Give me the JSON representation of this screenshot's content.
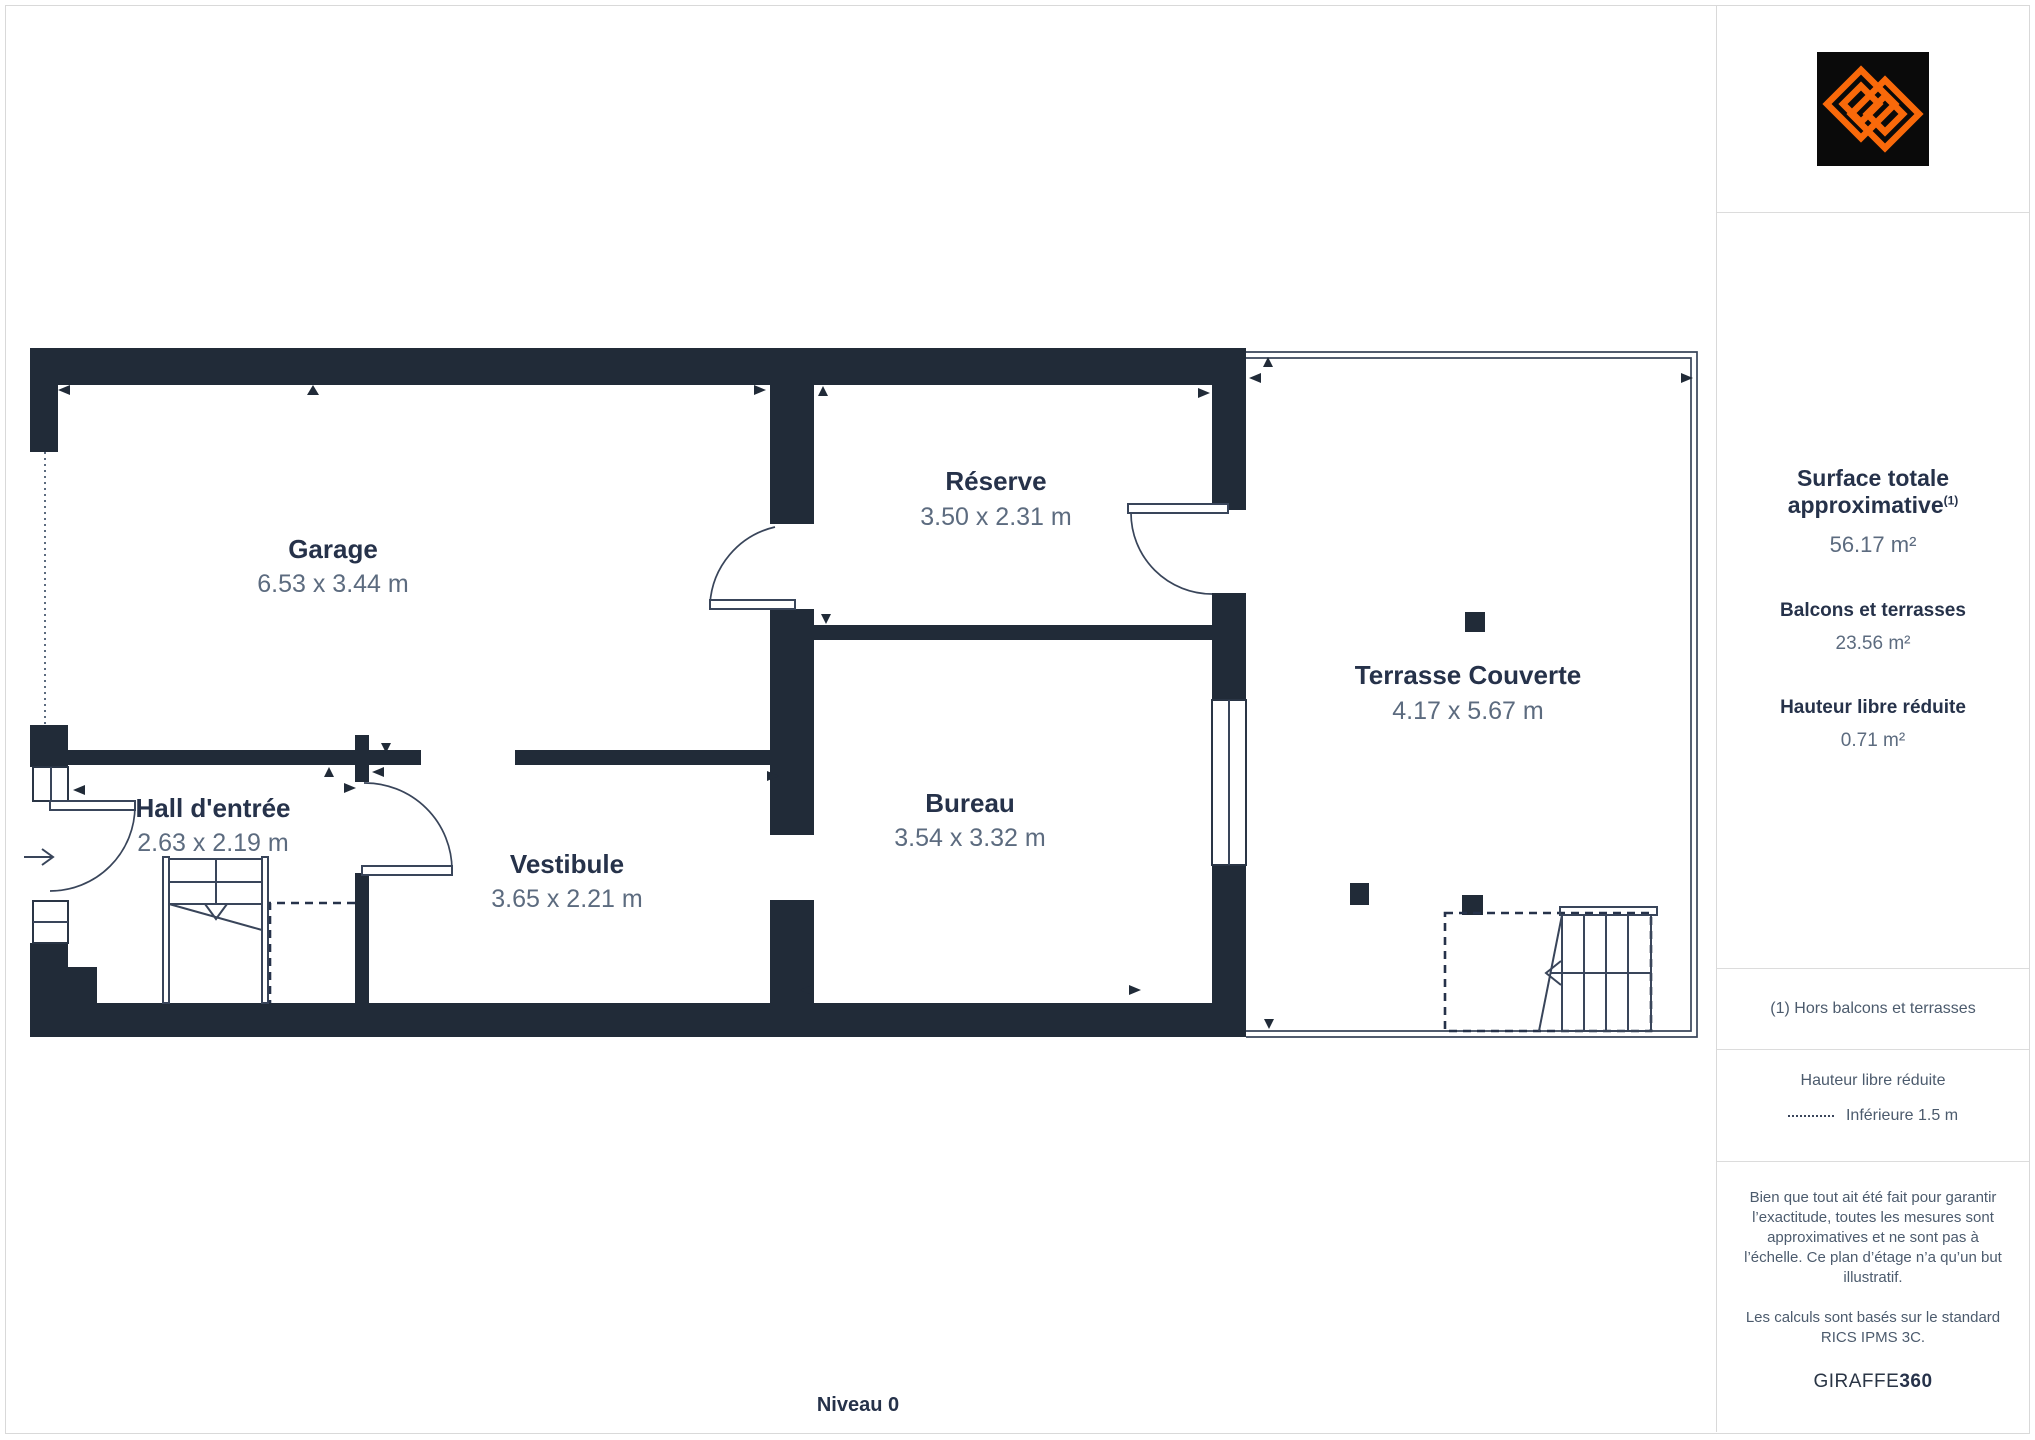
{
  "colors": {
    "wall": "#212B38",
    "accent_orange": "#F9690A",
    "label_dark": "#26324A",
    "label_muted": "#5C6B7F",
    "divider": "#DCDCDC"
  },
  "plan": {
    "level_label": "Niveau 0",
    "rooms": [
      {
        "name": "Garage",
        "dims": "6.53 x 3.44 m"
      },
      {
        "name": "Réserve",
        "dims": "3.50 x 2.31 m"
      },
      {
        "name": "Hall d'entrée",
        "dims": "2.63 x 2.19 m"
      },
      {
        "name": "Vestibule",
        "dims": "3.65 x 2.21 m"
      },
      {
        "name": "Bureau",
        "dims": "3.54 x 3.32 m"
      },
      {
        "name": "Terrasse Couverte",
        "dims": "4.17 x 5.67 m"
      }
    ]
  },
  "sidebar": {
    "total_label": "Surface totale approximative",
    "total_footnote_marker": "(1)",
    "total_value": "56.17 m²",
    "sections": [
      {
        "label": "Balcons et terrasses",
        "value": "23.56 m²"
      },
      {
        "label": "Hauteur libre réduite",
        "value": "0.71 m²"
      }
    ],
    "footnote": "(1) Hors balcons et terrasses",
    "legend_title": "Hauteur libre réduite",
    "legend_item": "Inférieure 1.5 m",
    "disclaimer_1": "Bien que tout ait été fait pour garantir l’exactitude, toutes les mesures sont approximatives et ne sont pas à l’échelle. Ce plan d’étage n’a qu’un but illustratif.",
    "disclaimer_2": "Les calculs sont basés sur le standard RICS IPMS 3C.",
    "brand_name": "GIRAFFE",
    "brand_suffix": "360"
  }
}
